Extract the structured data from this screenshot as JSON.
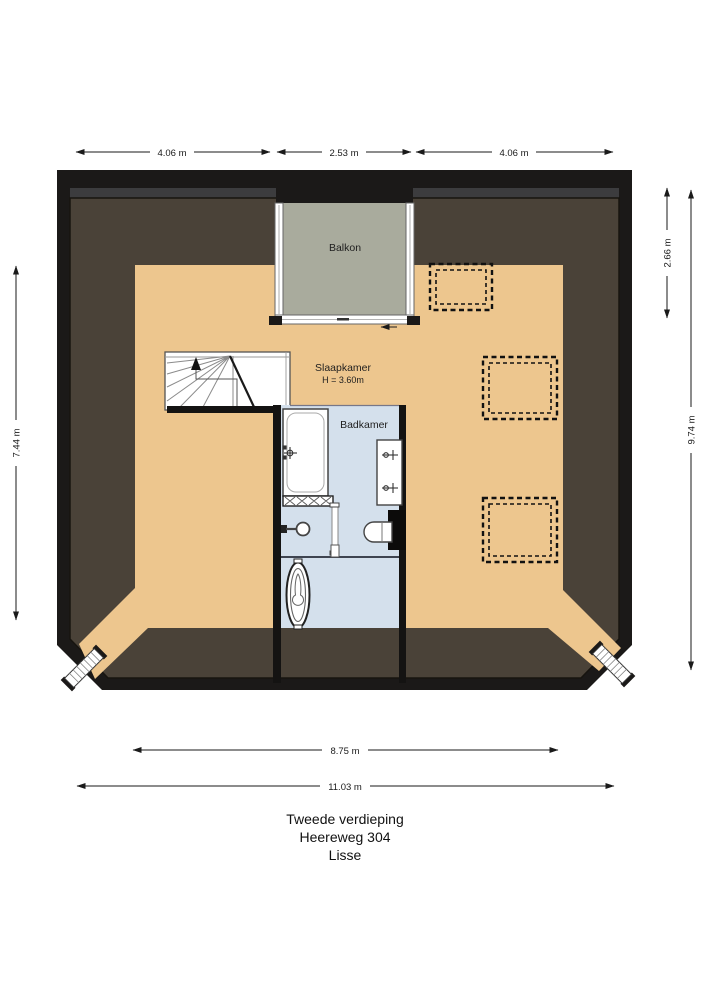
{
  "labels": {
    "balkon": "Balkon",
    "slaapkamer": "Slaapkamer",
    "slaapkamer_height": "H = 3.60m",
    "badkamer": "Badkamer"
  },
  "dimensions": {
    "top_left": "4.06 m",
    "top_center": "2.53 m",
    "top_right": "4.06 m",
    "right_upper": "2.66 m",
    "right_full": "9.74 m",
    "left_side": "7.44 m",
    "bottom_inner": "8.75 m",
    "bottom_full": "11.03 m"
  },
  "title": {
    "floor": "Tweede verdieping",
    "street": "Heereweg 304",
    "city": "Lisse"
  },
  "colors": {
    "wall": "#1b1918",
    "roof": "#4a4238",
    "roof_step": "#3c3c3e",
    "floor": "#edc68e",
    "balcony": "#a9ab9d",
    "bathroom": "#d4e0ec"
  }
}
